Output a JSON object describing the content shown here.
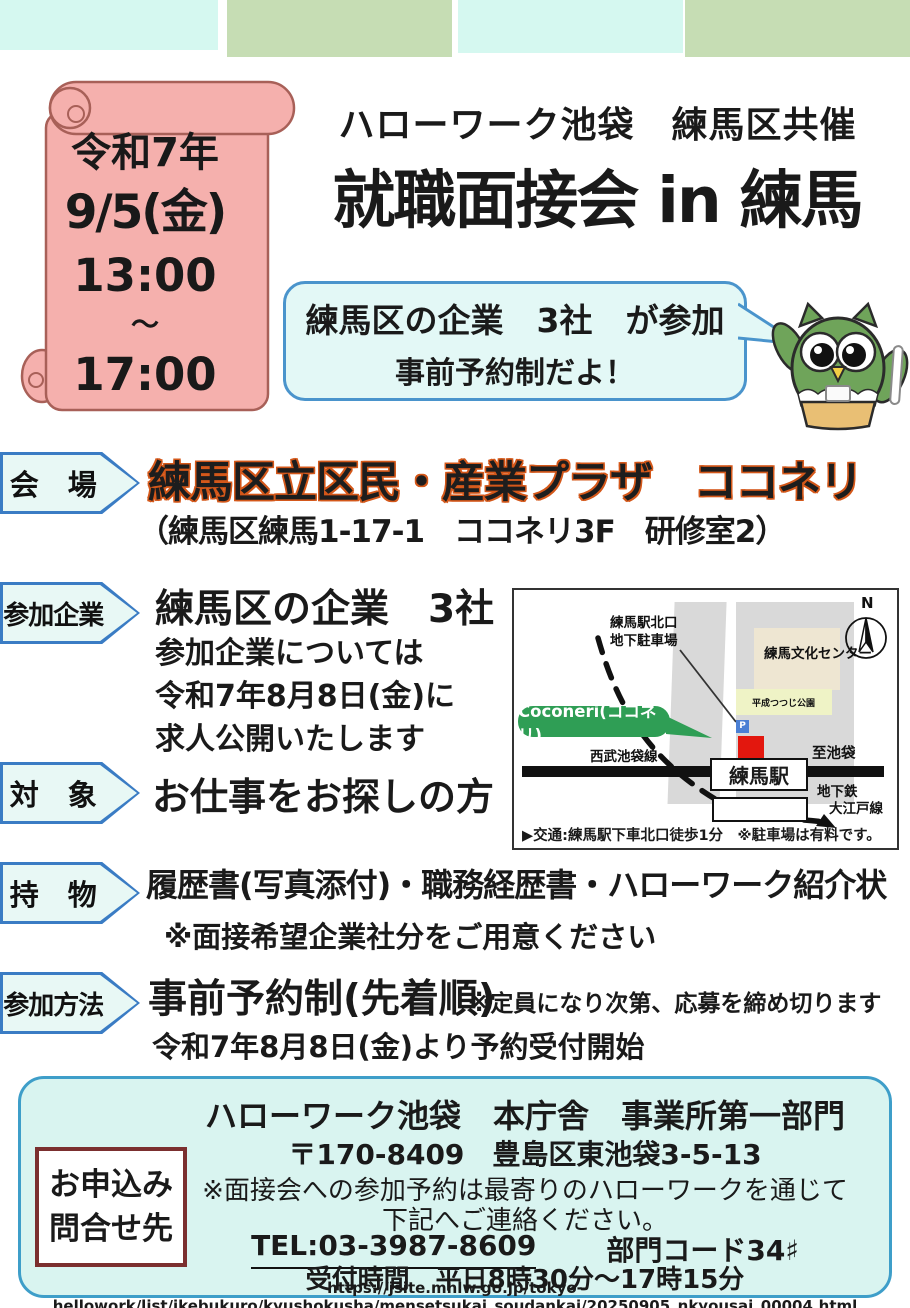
{
  "top_banner": {
    "subtitle": "ハローワーク池袋　練馬区共催",
    "title": "就職面接会 in 練馬"
  },
  "date_scroll": {
    "era_year": "令和7年",
    "date": "9/5(金)",
    "time_start": "13:00",
    "tilde": "〜",
    "time_end": "17:00"
  },
  "bubble": {
    "line1": "練馬区の企業　3社　が参加",
    "line2": "事前予約制だよ！"
  },
  "sections": {
    "venue": {
      "label": "会　場",
      "title": "練馬区立区民・産業プラザ　ココネリ",
      "address": "（練馬区練馬1-17-1　ココネリ3F　研修室2）"
    },
    "companies": {
      "label": "参加企業",
      "title": "練馬区の企業　3社",
      "line1": "参加企業については",
      "line2": "令和7年8月8日(金)に",
      "line3": "求人公開いたします"
    },
    "target": {
      "label": "対　象",
      "title": "お仕事をお探しの方"
    },
    "items": {
      "label": "持　物",
      "title": "履歴書(写真添付)・職務経歴書・ハローワーク紹介状",
      "note": "※面接希望企業社分をご用意ください"
    },
    "method": {
      "label": "参加方法",
      "title": "事前予約制(先着順)",
      "inline_note": "※定員になり次第、応募を締め切ります",
      "sub": "令和7年8月8日(金)より予約受付開始"
    }
  },
  "map": {
    "parking_line1": "練馬駅北口",
    "parking_line2": "地下駐車場",
    "culture_center": "練馬文化センター",
    "park": "平成つつじ公園",
    "parking_icon": "P",
    "coconeri_badge": "Coconeri(ココネリ)",
    "seibu_line": "西武池袋線",
    "to_ikebukuro": "至池袋",
    "station": "練馬駅",
    "subway_line1": "地下鉄",
    "subway_line2": "大江戸線",
    "compass": "N",
    "access_marker": "▶",
    "access": "交通:練馬駅下車北口徒歩1分",
    "access_note": "※駐車場は有料です。"
  },
  "contact": {
    "box_line1": "お申込み",
    "box_line2": "問合せ先",
    "org": "ハローワーク池袋　本庁舎　事業所第一部門",
    "postal_address": "〒170-8409　豊島区東池袋3-5-13",
    "note1": "※面接会への参加予約は最寄りのハローワークを通じて",
    "note2": "下記へご連絡ください。",
    "tel": "TEL:03-3987-8609",
    "dept_code": "部門コード34♯",
    "hours": "受付時間　平日8時30分〜17時15分",
    "url": "https://jsite.mhlw.go.jp/tokyo-hellowork/list/ikebukuro/kyushokusha/mensetsukai_soudankai/20250905_nkyousai_00004.html"
  },
  "colors": {
    "bar_cyan": "#d5f8f0",
    "bar_green": "#c6ddb4",
    "scroll_pink": "#f5b0ad",
    "scroll_outline": "#a86058",
    "bubble_fill": "#e3f8f6",
    "bubble_border": "#4a94cc",
    "label_border": "#3a7cc4",
    "venue_text_outline": "#d4581a",
    "coconeri_green": "#2f9e55",
    "map_building_red": "#e3170e",
    "contact_fill": "#d9f4f0",
    "contact_border": "#3e9ec9",
    "contact_box_border": "#7b2f2f"
  }
}
